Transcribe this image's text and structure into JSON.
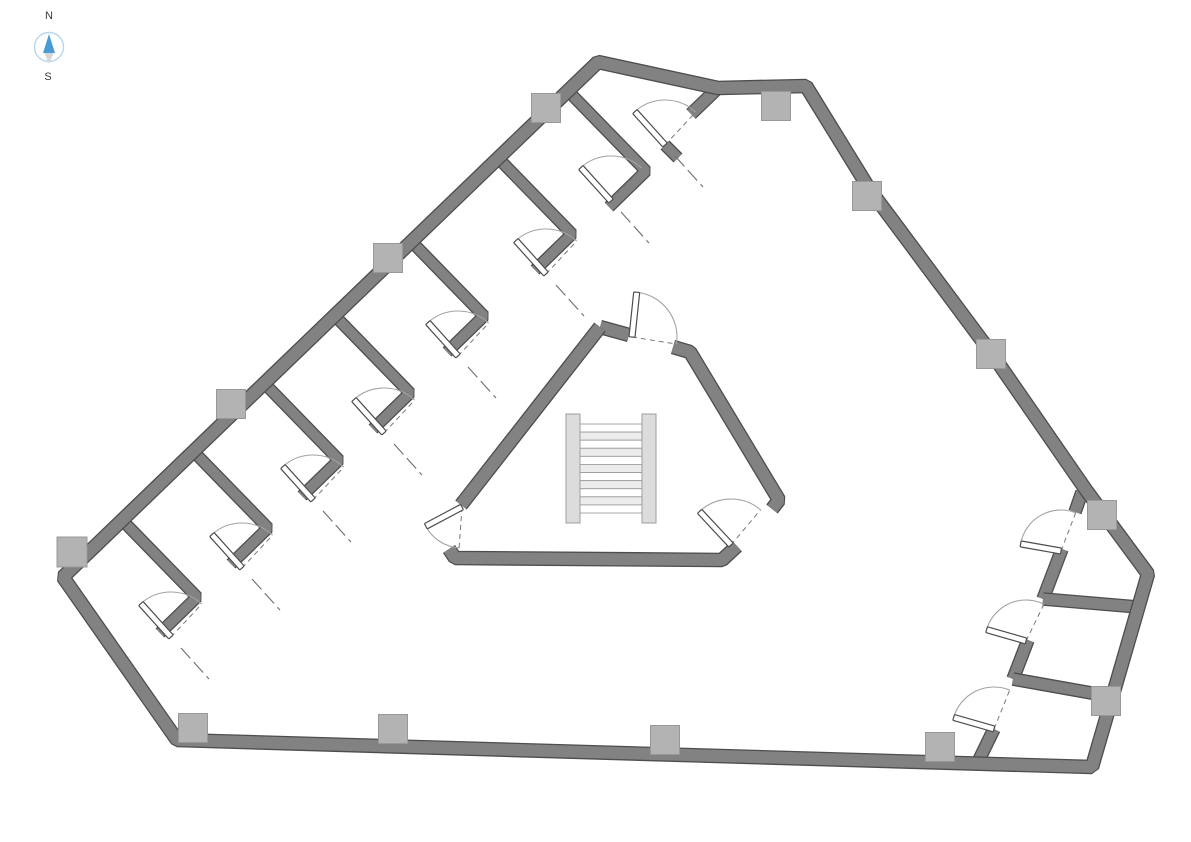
{
  "compass": {
    "north_label": "N",
    "south_label": "S",
    "ring_color": "#b9d6ec",
    "needle_north_color": "#4a9bd5",
    "needle_south_color": "#d6d6d6",
    "label_color": "#3a3a3a"
  },
  "palette": {
    "background": "#ffffff",
    "wall_fill": "#828282",
    "wall_edge": "#4d4d4d",
    "column_fill": "#b3b3b3",
    "column_edge": "#989898",
    "door_arc": "#a3a3a3",
    "door_leaf_fill": "#ffffff",
    "door_leaf_edge": "#4d4d4d",
    "door_dash": "#787878",
    "threshold_line": "#6e6e6e",
    "stair_stringer": "#dcdcdc",
    "stair_edge": "#9e9e9e",
    "stair_tread_a": "#ffffff",
    "stair_tread_b": "#ececec"
  },
  "canvas": {
    "width": 1191,
    "height": 842
  },
  "plan": {
    "walls": [
      {
        "name": "partition-1",
        "t": 10,
        "pts": [
          [
            123,
            521
          ],
          [
            197,
            597
          ],
          [
            160,
            633
          ]
        ]
      },
      {
        "name": "partition-2",
        "t": 10,
        "pts": [
          [
            194,
            452
          ],
          [
            268,
            528
          ],
          [
            231,
            564
          ]
        ]
      },
      {
        "name": "partition-3",
        "t": 10,
        "pts": [
          [
            265,
            384
          ],
          [
            339,
            460
          ],
          [
            302,
            496
          ]
        ]
      },
      {
        "name": "partition-4",
        "t": 10,
        "pts": [
          [
            336,
            317
          ],
          [
            410,
            393
          ],
          [
            373,
            429
          ]
        ]
      },
      {
        "name": "partition-5",
        "t": 10,
        "pts": [
          [
            410,
            240
          ],
          [
            484,
            316
          ],
          [
            447,
            352
          ]
        ]
      },
      {
        "name": "partition-6",
        "t": 10,
        "pts": [
          [
            498,
            158
          ],
          [
            572,
            234
          ],
          [
            535,
            270
          ]
        ]
      },
      {
        "name": "partition-7",
        "t": 10,
        "pts": [
          [
            572,
            95
          ],
          [
            646,
            171
          ],
          [
            609,
            207
          ]
        ]
      },
      {
        "name": "peak-room-side-wall",
        "t": 11,
        "pts": [
          [
            718,
            88
          ],
          [
            691,
            114
          ]
        ]
      },
      {
        "name": "peak-room-door-stub",
        "t": 10,
        "pts": [
          [
            665,
            145
          ],
          [
            678,
            158
          ]
        ]
      },
      {
        "name": "core-top-left",
        "t": 12,
        "pts": [
          [
            600,
            327
          ],
          [
            629,
            335
          ]
        ]
      },
      {
        "name": "core-east",
        "t": 12,
        "pts": [
          [
            673,
            347
          ],
          [
            690,
            352
          ],
          [
            779,
            500
          ],
          [
            772,
            509
          ]
        ]
      },
      {
        "name": "core-south",
        "t": 12,
        "pts": [
          [
            737,
            546
          ],
          [
            722,
            560
          ],
          [
            455,
            558
          ],
          [
            449,
            549
          ]
        ]
      },
      {
        "name": "core-northwest",
        "t": 12,
        "pts": [
          [
            461,
            505
          ],
          [
            600,
            327
          ]
        ]
      },
      {
        "name": "se-inner-wall-1",
        "t": 11,
        "pts": [
          [
            1082,
            492
          ],
          [
            1075,
            512
          ]
        ]
      },
      {
        "name": "se-inner-wall-2",
        "t": 11,
        "pts": [
          [
            1062,
            549
          ],
          [
            1043,
            599
          ]
        ]
      },
      {
        "name": "se-inner-wall-3",
        "t": 11,
        "pts": [
          [
            1028,
            640
          ],
          [
            1013,
            679
          ]
        ]
      },
      {
        "name": "se-inner-wall-4",
        "t": 11,
        "pts": [
          [
            994,
            729
          ],
          [
            977,
            764
          ]
        ]
      },
      {
        "name": "se-cross-wall-1",
        "t": 11,
        "pts": [
          [
            1043,
            599
          ],
          [
            1138,
            607
          ]
        ]
      },
      {
        "name": "se-cross-wall-2",
        "t": 11,
        "pts": [
          [
            1013,
            679
          ],
          [
            1114,
            697
          ]
        ]
      },
      {
        "name": "outer-boundary",
        "t": 12,
        "closed": true,
        "pts": [
          [
            598,
            62
          ],
          [
            718,
            88
          ],
          [
            806,
            86
          ],
          [
            870,
            190
          ],
          [
            992,
            354
          ],
          [
            1086,
            490
          ],
          [
            1148,
            574
          ],
          [
            1092,
            767
          ],
          [
            177,
            740
          ],
          [
            63,
            577
          ]
        ]
      }
    ],
    "columns": [
      {
        "x": 546,
        "y": 108,
        "s": 29
      },
      {
        "x": 776,
        "y": 106,
        "s": 29
      },
      {
        "x": 867,
        "y": 196,
        "s": 29
      },
      {
        "x": 991,
        "y": 354,
        "s": 29
      },
      {
        "x": 1102,
        "y": 515,
        "s": 29
      },
      {
        "x": 1106,
        "y": 701,
        "s": 29
      },
      {
        "x": 940,
        "y": 747,
        "s": 29
      },
      {
        "x": 665,
        "y": 740,
        "s": 29
      },
      {
        "x": 393,
        "y": 729,
        "s": 29
      },
      {
        "x": 193,
        "y": 728,
        "s": 29
      },
      {
        "x": 72,
        "y": 552,
        "s": 30
      },
      {
        "x": 231,
        "y": 404,
        "s": 29
      },
      {
        "x": 388,
        "y": 258,
        "s": 29
      }
    ],
    "doors": [
      {
        "name": "room-door-1",
        "hinge": [
          171,
          637
        ],
        "r": 45,
        "leaf": -132,
        "closed": -47,
        "sweep": 1,
        "tline": true
      },
      {
        "name": "room-door-2",
        "hinge": [
          242,
          568
        ],
        "r": 45,
        "leaf": -132,
        "closed": -47,
        "sweep": 1,
        "tline": true
      },
      {
        "name": "room-door-3",
        "hinge": [
          313,
          500
        ],
        "r": 45,
        "leaf": -132,
        "closed": -47,
        "sweep": 1,
        "tline": true
      },
      {
        "name": "room-door-4",
        "hinge": [
          384,
          433
        ],
        "r": 45,
        "leaf": -132,
        "closed": -47,
        "sweep": 1,
        "tline": true
      },
      {
        "name": "room-door-5",
        "hinge": [
          458,
          356
        ],
        "r": 45,
        "leaf": -132,
        "closed": -47,
        "sweep": 1,
        "tline": true
      },
      {
        "name": "room-door-6",
        "hinge": [
          546,
          274
        ],
        "r": 45,
        "leaf": -132,
        "closed": -47,
        "sweep": 1,
        "tline": true
      },
      {
        "name": "room-door-7",
        "hinge": [
          611,
          201
        ],
        "r": 45,
        "leaf": -132,
        "closed": -47,
        "sweep": 1,
        "tline": true
      },
      {
        "name": "room-door-8",
        "hinge": [
          665,
          145
        ],
        "r": 45,
        "leaf": -132,
        "closed": -47,
        "sweep": 1,
        "tline": true
      },
      {
        "name": "core-door-north",
        "hinge": [
          632,
          337
        ],
        "r": 45,
        "leaf": -84,
        "closed": 9,
        "sweep": 1
      },
      {
        "name": "core-door-west",
        "hinge": [
          462,
          507
        ],
        "r": 41,
        "leaf": 152,
        "closed": 94,
        "sweep": 0
      },
      {
        "name": "core-door-south",
        "hinge": [
          731,
          545
        ],
        "r": 46,
        "leaf": -133,
        "closed": -50,
        "sweep": 1
      },
      {
        "name": "se-room-door-1",
        "hinge": [
          1061,
          551
        ],
        "r": 41,
        "leaf": -170,
        "closed": -69,
        "sweep": 1
      },
      {
        "name": "se-room-door-2",
        "hinge": [
          1026,
          641
        ],
        "r": 41,
        "leaf": -164,
        "closed": -64,
        "sweep": 1
      },
      {
        "name": "se-room-door-3",
        "hinge": [
          994,
          729
        ],
        "r": 42,
        "leaf": -164,
        "closed": -68,
        "sweep": 1
      }
    ],
    "threshold_offset": {
      "from": [
        10,
        11
      ],
      "to": [
        38,
        42
      ]
    },
    "stairs": {
      "x": 566,
      "y": 414,
      "w": 90,
      "h": 109,
      "stringer_w": 14,
      "treads": 11
    }
  }
}
